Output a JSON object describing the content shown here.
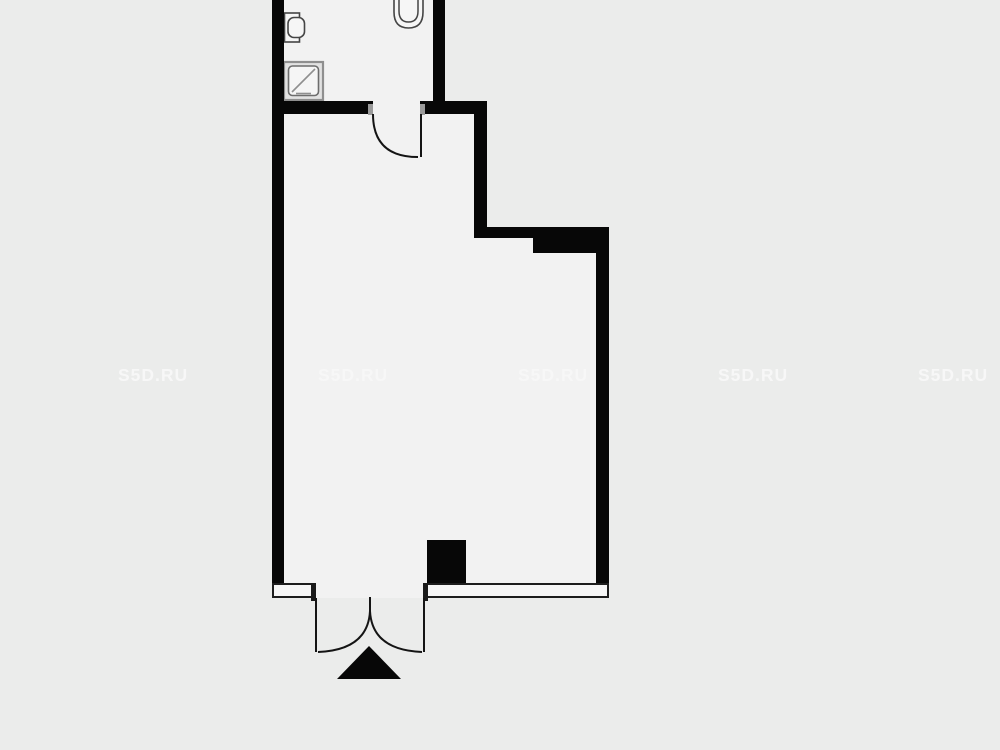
{
  "watermark": {
    "text": "S5D.RU",
    "count": 5,
    "color": "#f7f7f7"
  },
  "plan": {
    "type": "apartment-floor-plan",
    "colors": {
      "background": "#ebeceb",
      "room_fill": "#f2f2f2",
      "wall": "#070707",
      "door_line": "#141414",
      "fixture_stroke": "#454545",
      "shower_stroke": "#8f8f8f"
    },
    "rooms": [
      "bathroom",
      "main-room"
    ],
    "fixtures": [
      "toilet",
      "wash-basin",
      "shower-tray"
    ],
    "doors": [
      "bathroom-door-swing",
      "entrance-double-door-swing"
    ],
    "symbols": [
      "entrance-direction-arrow"
    ]
  }
}
